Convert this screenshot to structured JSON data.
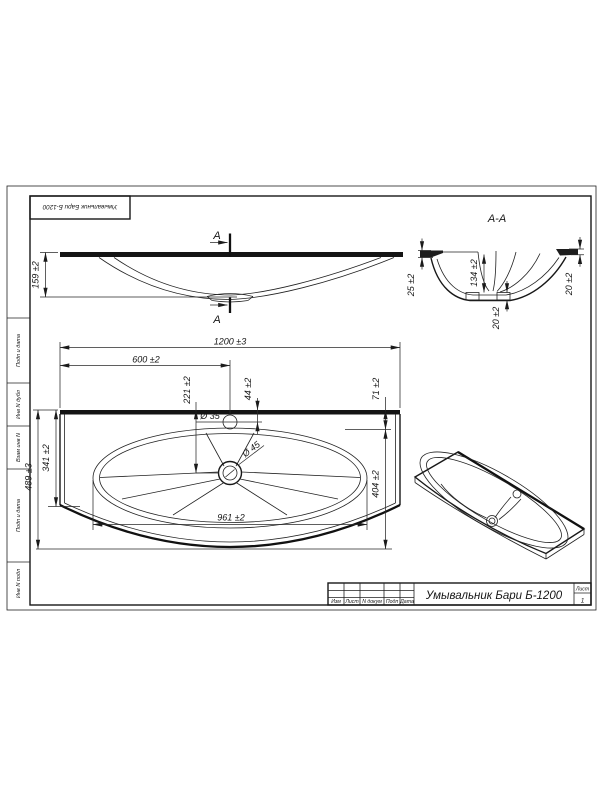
{
  "corner_stamp": {
    "text": "Умывальник Бари Б-1200"
  },
  "frame_side_labels": {
    "podp_data_top": "Подп и дата",
    "inv_dubl": "Инв N дубл",
    "vzam_inv": "Взам инв N",
    "podp_data_bottom": "Подп и дата",
    "inv_podl": "Инв N подл"
  },
  "front_view": {
    "dim_height": "159 ±2",
    "section_mark": "А"
  },
  "section_view": {
    "label": "А-А",
    "dim_rim_left": "25 ±2",
    "dim_bowl_depth": "134 ±2",
    "dim_drain_depth": "20 ±2",
    "dim_rim_right": "20 ±2"
  },
  "plan_view": {
    "dim_total_width": "1200 ±3",
    "dim_center": "600 ±2",
    "dim_drain_offset": "221 ±2",
    "dim_faucet_offset": "44 ±2",
    "dim_bowl_offset": "71 ±2",
    "dim_total_depth": "489 ±3",
    "dim_left_inner": "341 ±2",
    "dim_right_inner": "404 ±2",
    "dim_bowl_width": "961 ±2",
    "dim_faucet_hole": "Ø 35",
    "dim_drain_hole": "Ø 45"
  },
  "title_block": {
    "title": "Умывальник Бари Б-1200",
    "col_izm": "Изм",
    "col_list": "Лист",
    "col_docnum": "N докум",
    "col_podp": "Подп",
    "col_data": "Дата",
    "sheet_label": "Лист",
    "sheet_number": "1"
  }
}
